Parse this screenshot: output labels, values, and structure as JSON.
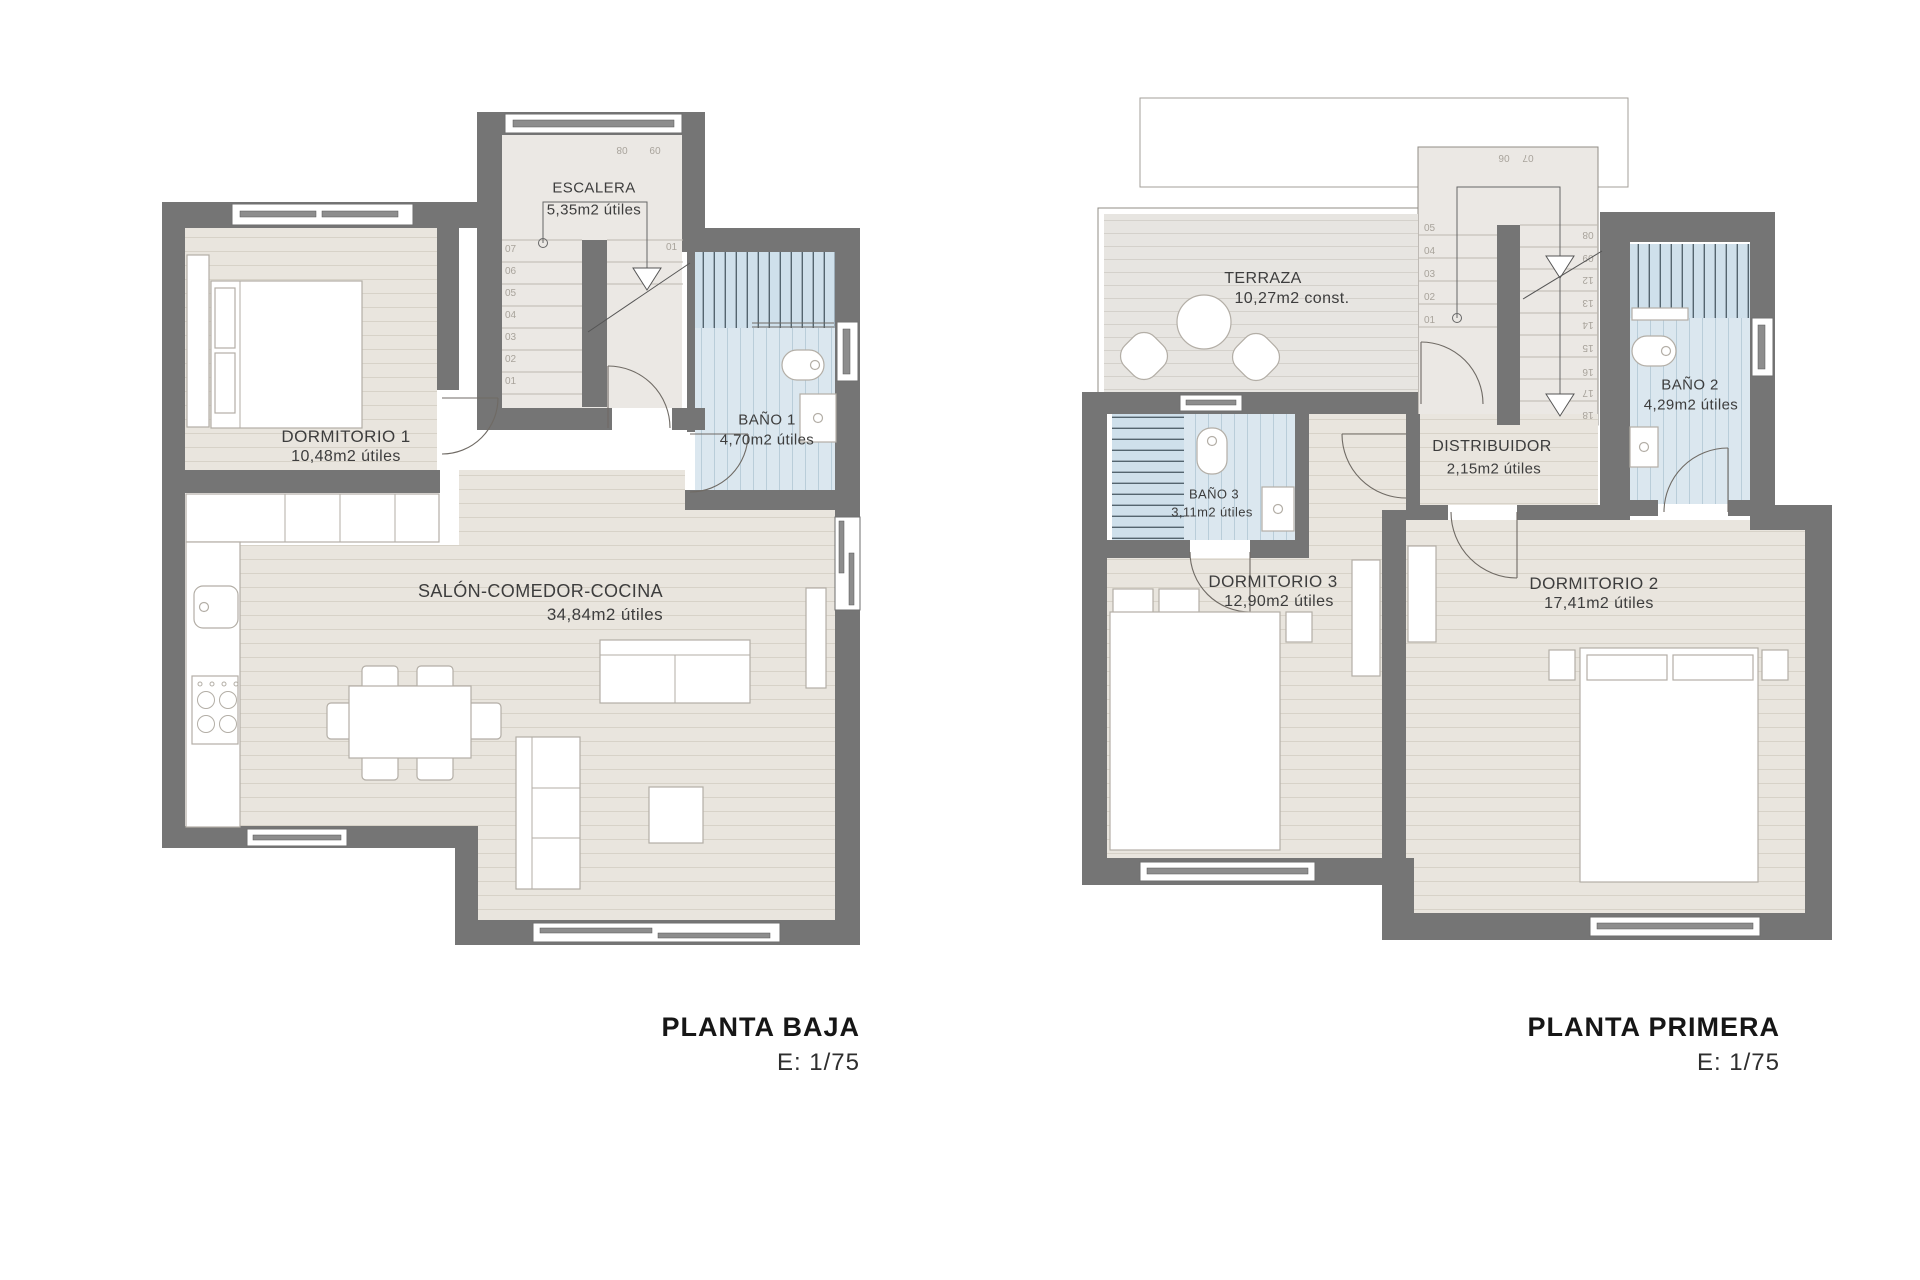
{
  "plans": {
    "left": {
      "title": "PLANTA BAJA",
      "scale": "E: 1/75",
      "rooms": {
        "escalera": {
          "name": "ESCALERA",
          "area": "5,35m2 útiles"
        },
        "dormitorio1": {
          "name": "DORMITORIO 1",
          "area": "10,48m2 útiles"
        },
        "bano1": {
          "name": "BAÑO 1",
          "area": "4,70m2 útiles"
        },
        "salon": {
          "name": "SALÓN-COMEDOR-COCINA",
          "area": "34,84m2 útiles"
        }
      },
      "stair_left": [
        "07",
        "06",
        "05",
        "04",
        "03",
        "02",
        "01"
      ],
      "stair_top": [
        "08",
        "09"
      ],
      "stair_right": [
        "01"
      ]
    },
    "right": {
      "title": "PLANTA PRIMERA",
      "scale": "E: 1/75",
      "rooms": {
        "terraza": {
          "name": "TERRAZA",
          "area": "10,27m2 const."
        },
        "bano3": {
          "name": "BAÑO 3",
          "area": "3,11m2 útiles"
        },
        "bano2": {
          "name": "BAÑO 2",
          "area": "4,29m2 útiles"
        },
        "distribuidor": {
          "name": "DISTRIBUIDOR",
          "area": "2,15m2 útiles"
        },
        "dormitorio3": {
          "name": "DORMITORIO 3",
          "area": "12,90m2 útiles"
        },
        "dormitorio2": {
          "name": "DORMITORIO 2",
          "area": "17,41m2 útiles"
        }
      },
      "stair_left": [
        "05",
        "04",
        "03",
        "02",
        "01"
      ],
      "stair_top": [
        "06",
        "07"
      ],
      "stair_right": [
        "08",
        "09",
        "12",
        "13",
        "14",
        "15",
        "16",
        "17",
        "18"
      ]
    }
  },
  "colors": {
    "wall": "#757575",
    "wood_floor": "#e9e5de",
    "terrace_floor": "#e7e5e1",
    "bath_floor": "#dbe7ef",
    "shower_stripe": "#54656f",
    "furniture_outline": "#b3aea6",
    "label_text": "#3d3d3d",
    "stair_number": "#a8a39b",
    "title_text": "#1c1c1c"
  }
}
